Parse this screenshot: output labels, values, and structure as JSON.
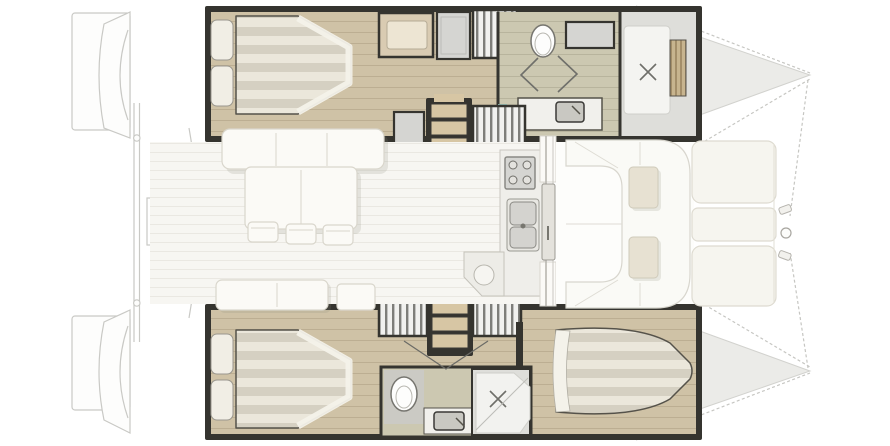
{
  "palette": {
    "bg": "#ffffff",
    "outline_faint": "#c9c9c5",
    "wall_dark": "#35342f",
    "wood": "#cfc2a6",
    "wood_line": "#bcae92",
    "wood_step": "#d7c6a4",
    "bath_floor": "#ccc8b1",
    "teal": "#9fc9c0",
    "mattress_a": "#ebe7db",
    "mattress_b": "#d5d0c2",
    "pillow": "#f1eee5",
    "white_furniture": "#fbfaf6",
    "furniture_border": "#d9d6cc",
    "salon_floor": "#f7f6f2",
    "salon_line": "#eae8e2",
    "cabinet_gray": "#d5d5d2",
    "vanity_beige": "#d9cbb2",
    "vanity_inner": "#ede5d3",
    "table_beige": "#e7e1d2",
    "shadow": "#8d887a"
  },
  "icons": {
    "toilet": "white oval bowl",
    "shower_drain": "x cross mark",
    "sink": "rounded basin with faucet dot",
    "stove": "four burner circles",
    "wardrobe": "hanging-rail vertical stripes",
    "steps": "three wooden treads",
    "bed": "striped mattress with two pillows",
    "sunpad": "rounded white cushion"
  }
}
